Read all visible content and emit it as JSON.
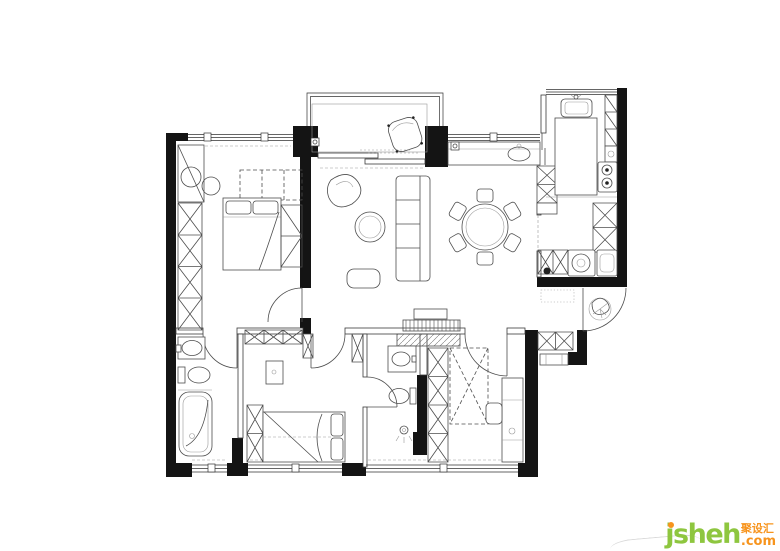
{
  "watermark": {
    "brand": "jsheh",
    "dot": ".",
    "tld": "com",
    "cjk": "聚设汇"
  },
  "colors": {
    "wall": "#141414",
    "line": "#4d4d4d",
    "light": "#999999",
    "logo_green": "#8ec63f",
    "logo_orange": "#f7941d"
  }
}
